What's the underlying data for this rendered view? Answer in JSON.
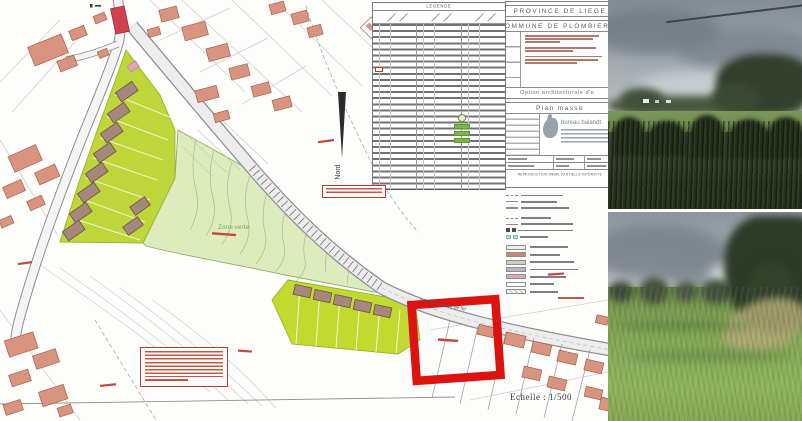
{
  "plan": {
    "scale_label": "Echelle : 1/500",
    "north_label": "Nord",
    "zone_label": "Zone verte",
    "street_label": "rue du Chemin de fer",
    "highlight_color": "#dc1310",
    "parcel_color": "#bed63a",
    "green_zone_color": "#dcecbe",
    "existing_building_color": "#d99480",
    "proposed_building_color": "#a5887b"
  },
  "legend": {
    "header": "LEGENDE",
    "highlight_swatch_color": "#7db648"
  },
  "title_block": {
    "province": "PROVINCE DE LIEGE",
    "commune": "COMMUNE DE PLOMBIERES",
    "option_label": "Option architecturale d'e",
    "plan_label": "Plan masse",
    "firm_name": "bureau balandt",
    "notice": "REPRODUCTION MEME PARTIELLE INTERDITE"
  },
  "color_legend": {
    "swatch_colors": [
      "#f2eedd",
      "#c98878",
      "#c9d0bd",
      "#b9b2c8",
      "#d9aabb",
      "#ffffff",
      "#ffffff"
    ]
  },
  "photos": [
    {
      "alt": "overgrown meadow with tree line under overcast sky"
    },
    {
      "alt": "sloping green pasture with trees at right under overcast sky"
    }
  ]
}
